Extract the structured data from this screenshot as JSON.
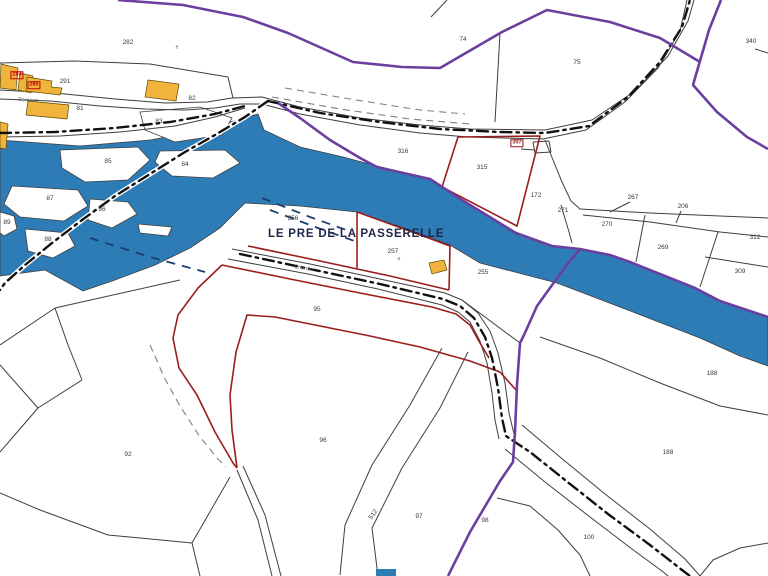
{
  "map": {
    "title": "LE PRE DE LA PASSERELLE",
    "title_pos": {
      "x": 268,
      "y": 228
    },
    "street_labels": [
      {
        "text": "Bernard",
        "x": 18,
        "y": 98,
        "rot": 4
      },
      {
        "text": "Chemin",
        "x": 294,
        "y": 265,
        "rot": 10
      }
    ],
    "boxed_labels": [
      {
        "text": "283",
        "x": 17,
        "y": 75,
        "color": "#c00000",
        "bg": "transparent"
      },
      {
        "text": "285",
        "x": 34,
        "y": 85,
        "color": "#c00000",
        "bg": "transparent"
      },
      {
        "text": "307",
        "x": 517,
        "y": 143,
        "color": "#8b1a1a",
        "bg": "#ffffff"
      }
    ],
    "parcel_labels": [
      {
        "text": "282",
        "x": 128,
        "y": 43
      },
      {
        "text": "74",
        "x": 463,
        "y": 40
      },
      {
        "text": "75",
        "x": 577,
        "y": 63
      },
      {
        "text": "340",
        "x": 751,
        "y": 42
      },
      {
        "text": "291",
        "x": 65,
        "y": 82
      },
      {
        "text": "81",
        "x": 80,
        "y": 109
      },
      {
        "text": "82",
        "x": 192,
        "y": 99
      },
      {
        "text": "83",
        "x": 159,
        "y": 122
      },
      {
        "text": "85",
        "x": 108,
        "y": 162
      },
      {
        "text": "84",
        "x": 185,
        "y": 165
      },
      {
        "text": "87",
        "x": 50,
        "y": 199
      },
      {
        "text": "86",
        "x": 102,
        "y": 210
      },
      {
        "text": "88",
        "x": 48,
        "y": 240
      },
      {
        "text": "89",
        "x": 7,
        "y": 223
      },
      {
        "text": "316",
        "x": 403,
        "y": 152
      },
      {
        "text": "315",
        "x": 482,
        "y": 168
      },
      {
        "text": "172",
        "x": 536,
        "y": 196
      },
      {
        "text": "271",
        "x": 563,
        "y": 211
      },
      {
        "text": "267",
        "x": 633,
        "y": 198
      },
      {
        "text": "270",
        "x": 607,
        "y": 225
      },
      {
        "text": "206",
        "x": 683,
        "y": 207
      },
      {
        "text": "269",
        "x": 663,
        "y": 248
      },
      {
        "text": "312",
        "x": 755,
        "y": 238
      },
      {
        "text": "309",
        "x": 740,
        "y": 272
      },
      {
        "text": "256",
        "x": 293,
        "y": 219
      },
      {
        "text": "257",
        "x": 393,
        "y": 252
      },
      {
        "text": "255",
        "x": 483,
        "y": 273
      },
      {
        "text": "95",
        "x": 317,
        "y": 310
      },
      {
        "text": "96",
        "x": 323,
        "y": 441
      },
      {
        "text": "92",
        "x": 128,
        "y": 455
      },
      {
        "text": "512",
        "x": 374,
        "y": 515,
        "rot": -55
      },
      {
        "text": "97",
        "x": 419,
        "y": 517
      },
      {
        "text": "98",
        "x": 485,
        "y": 521
      },
      {
        "text": "188",
        "x": 712,
        "y": 374
      },
      {
        "text": "188",
        "x": 668,
        "y": 453
      },
      {
        "text": "100",
        "x": 589,
        "y": 538
      }
    ],
    "marks": [
      {
        "text": "e",
        "x": 177,
        "y": 48
      },
      {
        "text": "e",
        "x": 399,
        "y": 260
      }
    ],
    "colors": {
      "river_blue": "#2d7cb6",
      "boundary_purple": "#6b3fa0",
      "selection_red": "#9b1d1d",
      "building_yellow": "#f0b43c",
      "parcel_line": "#3f3f3f",
      "dashdot_black": "#111111",
      "title_navy": "#1f2547"
    }
  }
}
